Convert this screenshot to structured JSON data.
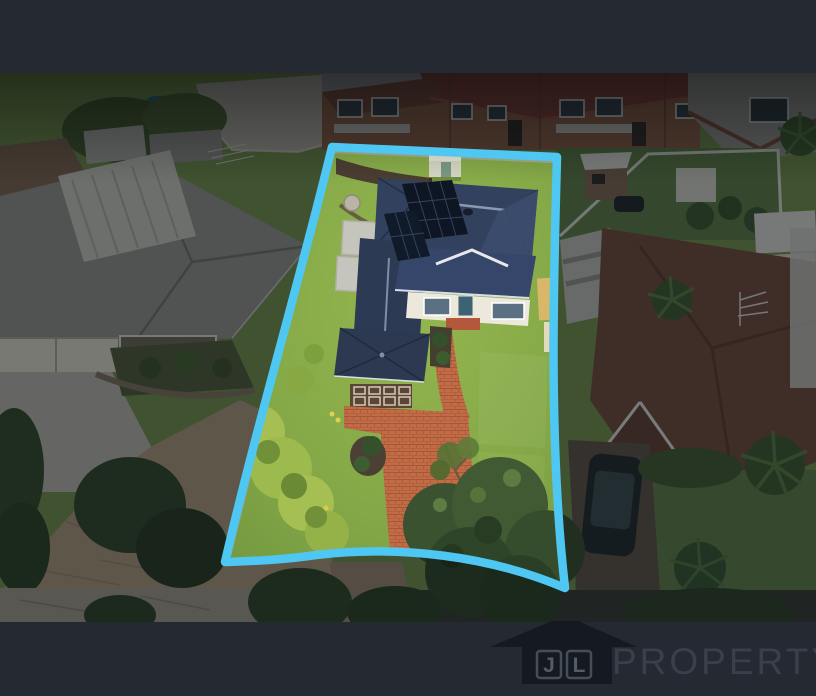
{
  "branding": {
    "initials": [
      "J",
      "L"
    ],
    "wordmark": "PROPERTY",
    "icon": "house-icon"
  },
  "colors": {
    "frame": "#242932",
    "boundary": "#4ec8f2",
    "logo_house": "#151a20",
    "logo_box": "#454e59",
    "logo_initials": "#535c67",
    "logo_wordmark": "#394049"
  }
}
